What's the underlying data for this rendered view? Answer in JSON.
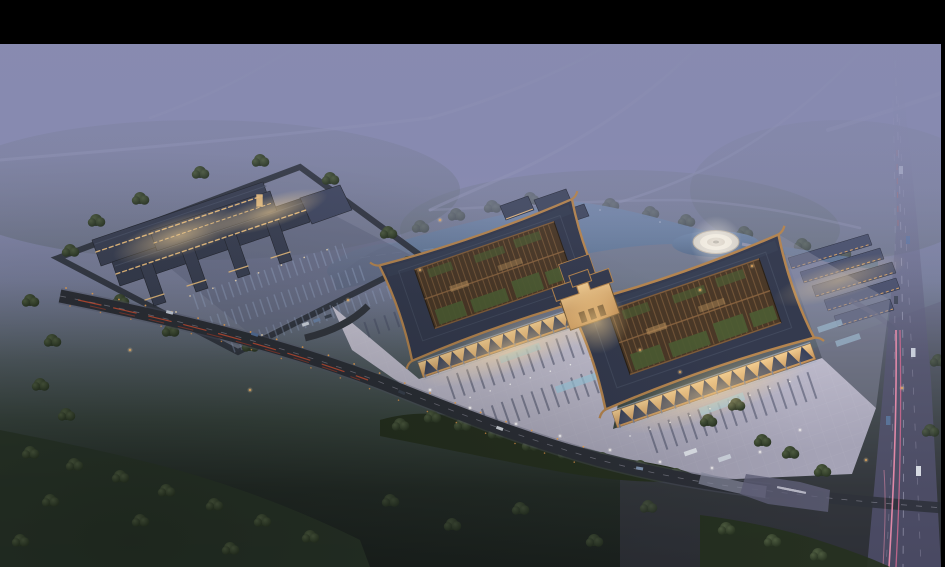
{
  "meta": {
    "type": "architectural-aerial-rendering",
    "time_of_day": "dusk",
    "subject": "Bird's-eye dusk rendering of a large traditional-roof commercial complex with two curved-roof halls, central gate, illuminated plaza and parking, secondary market complex, pond with circular fountain plaza, row buildings, perimeter roads, highway and dark fields"
  },
  "frame": {
    "background": "#000000",
    "top_bar_px": 44,
    "right_bar_px": 4,
    "canvas_w": 945,
    "canvas_h": 567
  },
  "palette": {
    "fog": "#8185b1",
    "sky_mist": "#9a9cc0",
    "field_dark": "#1c2320",
    "forest": "#2a3629",
    "forest_light": "#46573c",
    "water": "#527092",
    "plaza": "#bfbccd",
    "plaza_glow": "#f2e2b8",
    "roof_dark": "#343a4e",
    "roof_copper": "#b5854f",
    "courtyard_brown": "#4a3827",
    "courtyard_green": "#4c5c33",
    "facade_warm": "#e8bd7e",
    "colonnade_truss": "#39425c",
    "road_dark": "#2c2f37",
    "road_faint": "#a6a9c6",
    "highway": "#565670",
    "taillight_red": "#dd5233",
    "streak_pink": "#ef8fae",
    "lamp_orange": "#f2a854",
    "lamp_white": "#fff6e0",
    "parking_blue": "#9db0d0",
    "canopy_blue": "#9fcade",
    "fountain_plaza": "#d7d2c9"
  }
}
